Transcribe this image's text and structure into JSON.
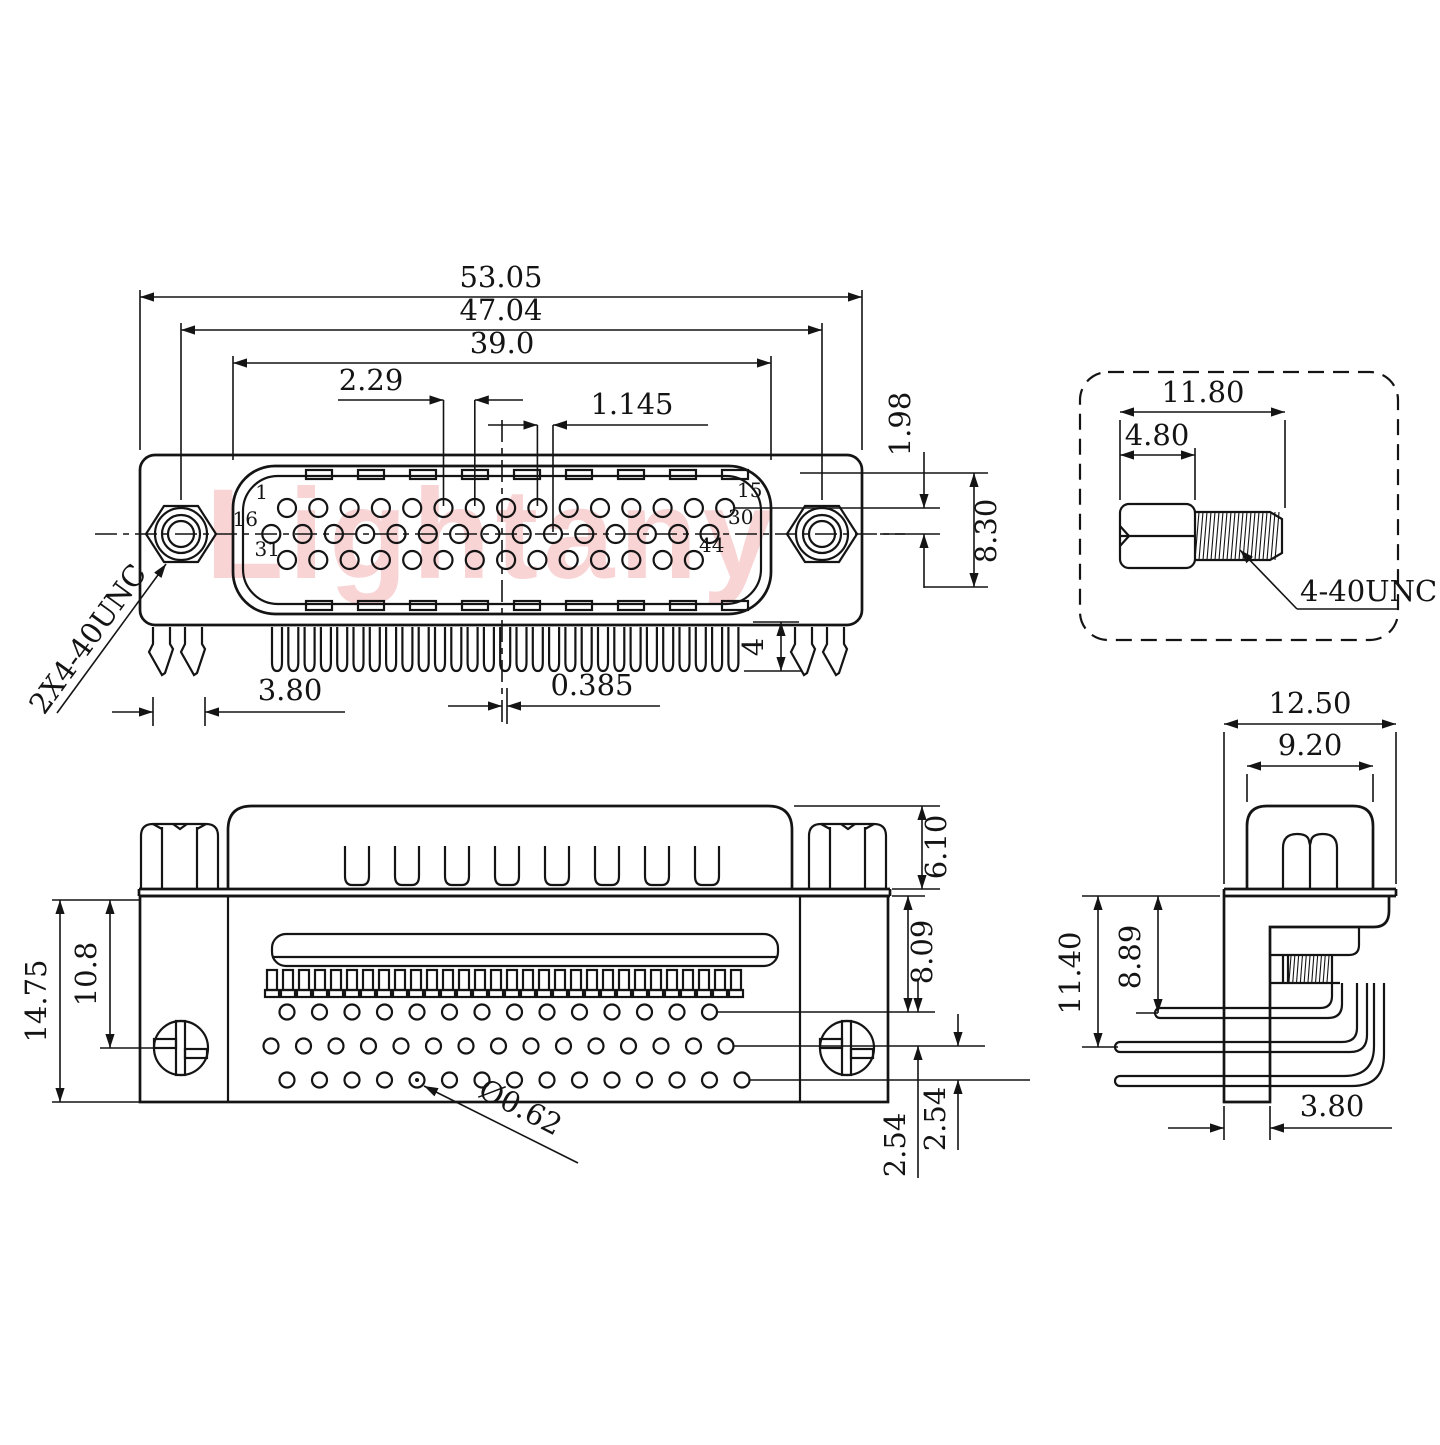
{
  "watermark": "Lightany",
  "front_view": {
    "dim_total_width": "53.05",
    "dim_mount_spacing": "47.04",
    "dim_shell_width": "39.0",
    "dim_pin_pitch": "2.29",
    "dim_half_pitch": "1.145",
    "dim_row_offset": "1.98",
    "dim_nut_size": "8.30",
    "dim_tail_length": "4",
    "dim_leg_spacing": "3.80",
    "dim_tail_offset": "0.385",
    "label_screw_thread": "2X4-40UNC",
    "pin_labels": {
      "p1": "1",
      "p15": "15",
      "p16": "16",
      "p30": "30",
      "p31": "31",
      "p44": "44"
    },
    "pin_rows": [
      15,
      15,
      14
    ],
    "tail_count": 29,
    "notch_count": 9
  },
  "screw_detail": {
    "dim_total_length": "11.80",
    "dim_head_length": "4.80",
    "label_thread": "4-40UNC"
  },
  "bottom_view": {
    "dim_total_height": "14.75",
    "dim_screw_center": "10.8",
    "dim_standoff_height": "6.10",
    "dim_body_height": "8.09",
    "dim_row_spacing_1": "2.54",
    "dim_row_spacing_2": "2.54",
    "label_hole_dia": "Ø0.62",
    "hole_rows": [
      14,
      15,
      15
    ],
    "slot_count": 8,
    "comb_tooth_count": 30
  },
  "side_view": {
    "dim_flange_width": "12.50",
    "dim_standoff_width": "9.20",
    "dim_total_height": "11.40",
    "dim_pin_height": "8.89",
    "dim_plate_thickness": "3.80"
  }
}
